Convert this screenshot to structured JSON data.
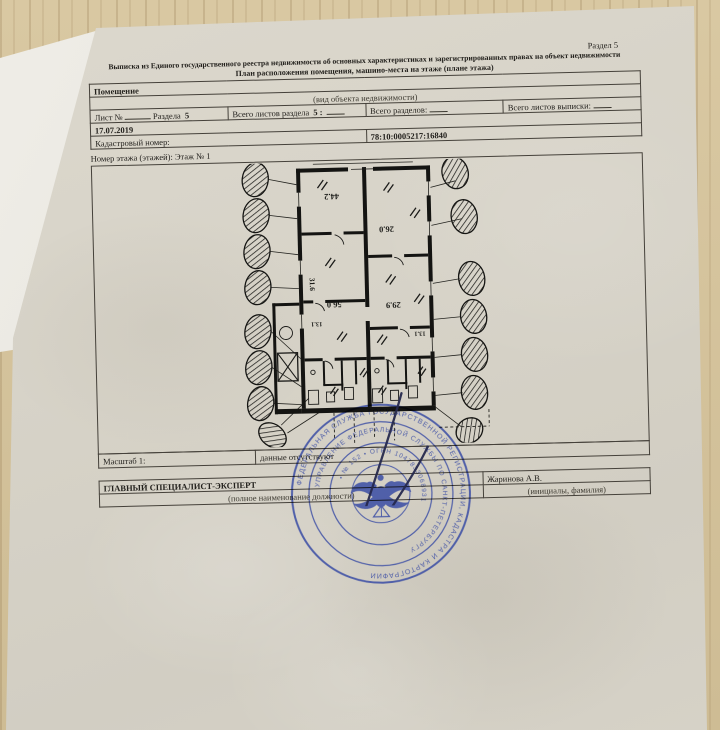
{
  "page": {
    "section_label": "Раздел 5"
  },
  "header": {
    "title_line1": "Выписка из Единого государственного реестра недвижимости об основных характеристиках и зарегистрированных правах на объект недвижимости",
    "title_line2": "План расположения помещения, машино-места на этаже (плане этажа)"
  },
  "info_table": {
    "object_type": "Помещение",
    "object_type_caption": "(вид объекта недвижимости)",
    "sheet_label": "Лист №",
    "section_word": "Раздела",
    "section_number": "5",
    "sheets_in_section_label": "Всего листов раздела",
    "sheets_in_section_number": "5 :",
    "total_sections_label": "Всего разделов:",
    "total_sheets_label": "Всего листов выписки:",
    "date": "17.07.2019",
    "cadastral_label": "Кадастровый номер:",
    "cadastral_number": "78:10:0005217:16840"
  },
  "plan": {
    "floor_label": "Номер этажа (этажей): Этаж № 1",
    "area_labels": [
      "44.2",
      "26.0",
      "31.6",
      "56.0",
      "29.9",
      "13.1",
      "13.1"
    ],
    "scale_label": "Масштаб 1:",
    "scale_value": "данные отсутствуют"
  },
  "signature_block": {
    "position_title": "ГЛАВНЫЙ СПЕЦИАЛИСТ-ЭКСПЕРТ",
    "position_caption": "(полное наименование должности)",
    "signer_name": "Жаринова А.В.",
    "signer_caption": "(инициалы, фамилия)"
  },
  "stamp": {
    "ring_text_outer": "ФЕДЕРАЛЬНАЯ СЛУЖБА ГОСУДАРСТВЕННОЙ РЕГИСТРАЦИИ, КАДАСТРА И КАРТОГРАФИИ",
    "ring_text_middle": "УПРАВЛЕНИЕ ФЕДЕРАЛЬНОЙ СЛУЖБЫ ПО САНКТ-ПЕТЕРБУРГУ",
    "ring_text_inner": "• № 152 • ОГРН 1047833068931"
  },
  "colors": {
    "wood": "#d2c09a",
    "paper": "#d7d3c8",
    "under_sheet": "#eceae4",
    "ink": "#23211d",
    "stamp_blue": "#3d4fa5",
    "signature_ink": "#262a4e"
  }
}
